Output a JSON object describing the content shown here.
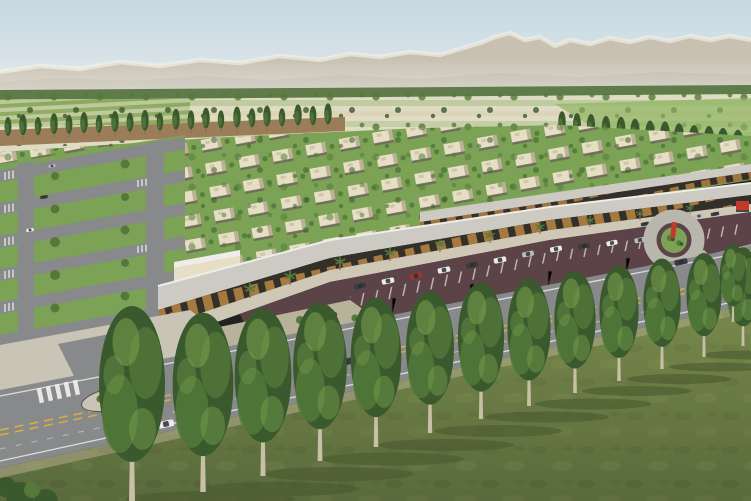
{
  "scene": {
    "type": "architectural-aerial-rendering",
    "description": "Aerial view of a master-planned desert community: hazy mountains, farmland with poplar windrows, rows of flat-roof beige houses, a retail strip with canopy and cafe umbrellas, maroon parking lot with cars, a boulevard with double-yellow lines, and a foreground row of tall trees on grass.",
    "time_of_day": "daytime",
    "no_visible_text": true
  },
  "objects": {
    "foreground_trees": 13,
    "left_poplar_row": 22,
    "right_poplar_row": 13,
    "palm_trees": 10,
    "cafe_umbrellas": 5,
    "parked_cars": 24,
    "cars_on_roads": 5,
    "cars_on_streets": 3,
    "residential_streets": 6,
    "retail_arcades": 2,
    "roundabout": 1,
    "crosswalks": 7,
    "median_island": 1
  },
  "colors": {
    "sky_top": "#c7d8e2",
    "sky_horizon": "#e0e8ea",
    "mountain": "#c8c1b2",
    "mountain_shadow": "#b5aea0",
    "snow": "#f1efe5",
    "treeline": "#5e7b49",
    "field_light": "#dedcc2",
    "field_green": "#a9bd87",
    "field_bright": "#8fb35f",
    "field_tan": "#d9cfae",
    "tilled": "#9c7d5a",
    "lawn": "#7ca355",
    "tree_dark": "#3a5a2e",
    "tree_mid": "#54793a",
    "tree_light": "#7ba24e",
    "house": "#e7dfc5",
    "house_shade": "#bdb298",
    "house_shadow": "#6e685a",
    "road": "#87898b",
    "road_light": "#b9b7ad",
    "sidewalk": "#c9c4b6",
    "line_white": "#f2f2ee",
    "line_yellow": "#d9b23f",
    "canopy": "#cdcac3",
    "canopy_edge": "#efede8",
    "storefront": "#33302a",
    "glow": "#c98f45",
    "parking": "#5c4347",
    "plaza": "#cfc8b6",
    "grass_top": "#77894b",
    "grass_bottom": "#596a3c",
    "grass_dark": "#4a5a30",
    "trunk": "#8a7456",
    "umbrella": "#d96f2b",
    "accent_red": "#c23b2a",
    "car_white": "#eceae6",
    "car_dark": "#3a3d40",
    "car_silver": "#b9bcbe",
    "car_red": "#9e3330",
    "windshield": "#2b2e31",
    "curb": "#55544e"
  }
}
